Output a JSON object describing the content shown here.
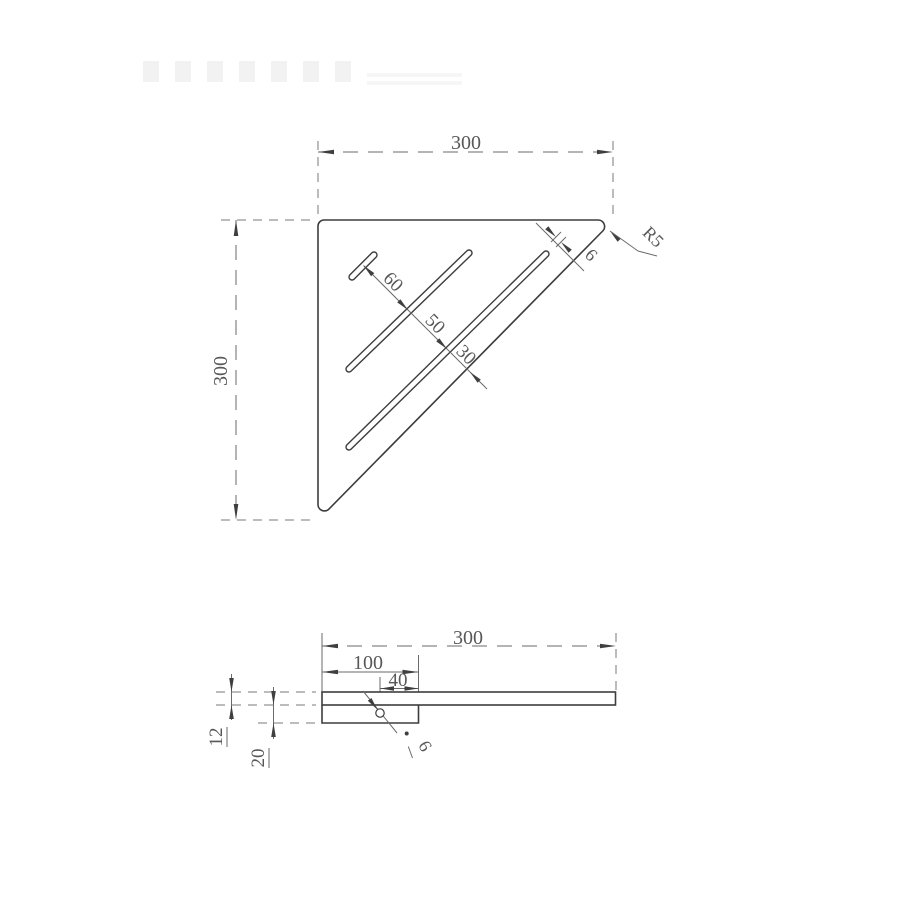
{
  "top_view": {
    "width": "300",
    "height": "300",
    "slot_gap_1": "60",
    "slot_gap_2": "50",
    "slot_gap_3": "30",
    "slot_width": "6",
    "corner_radius": "R5"
  },
  "side_view": {
    "width": "300",
    "bracket_length": "100",
    "hole_to_edge": "40",
    "plate_thickness": "12",
    "bracket_height": "20",
    "hole_diameter": "6"
  }
}
